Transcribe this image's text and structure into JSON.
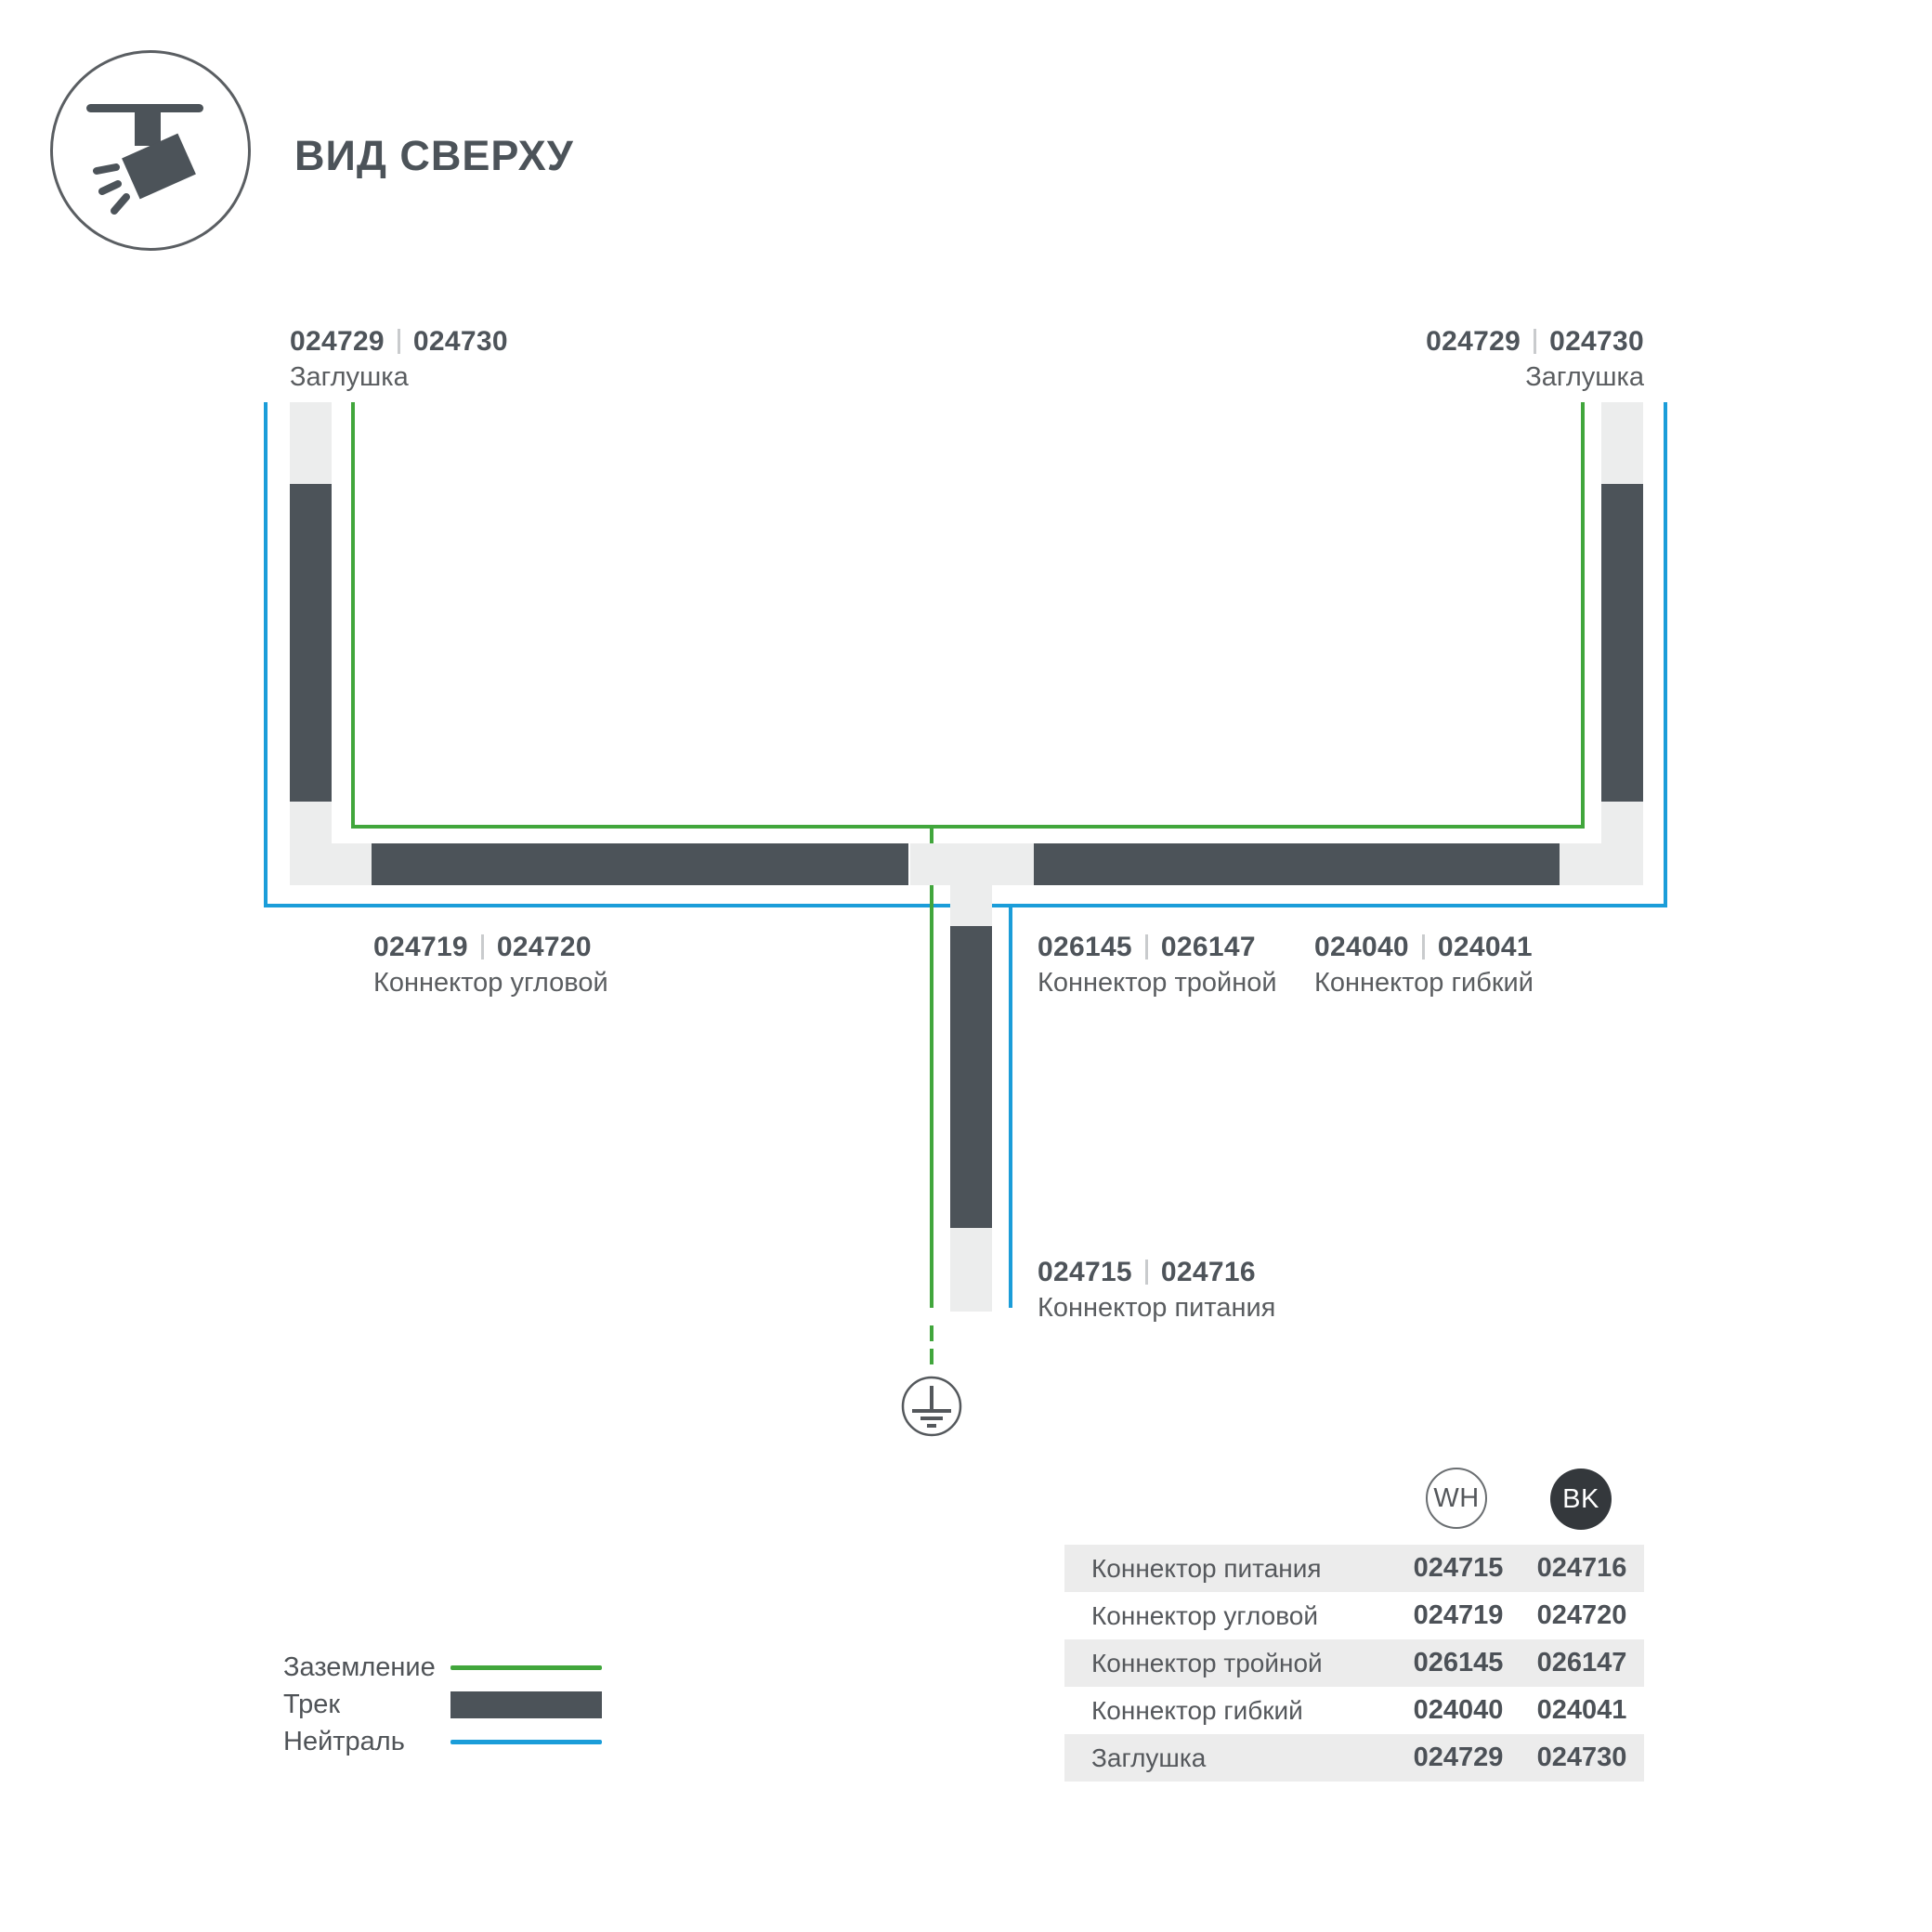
{
  "header": {
    "title": "ВИД СВЕРХУ"
  },
  "diagram": {
    "labels": {
      "endcap_left": {
        "code_wh": "024729",
        "code_bk": "024730",
        "name": "Заглушка"
      },
      "endcap_right": {
        "code_wh": "024729",
        "code_bk": "024730",
        "name": "Заглушка"
      },
      "corner": {
        "code_wh": "024719",
        "code_bk": "024720",
        "name": "Коннектор угловой"
      },
      "triple": {
        "code_wh": "026145",
        "code_bk": "026147",
        "name": "Коннектор тройной"
      },
      "flexible": {
        "code_wh": "024040",
        "code_bk": "024041",
        "name": "Коннектор гибкий"
      },
      "power": {
        "code_wh": "024715",
        "code_bk": "024716",
        "name": "Коннектор питания"
      }
    },
    "colors": {
      "ground_line": "#41A63C",
      "neutral_line": "#1B9DD9",
      "track": "#4C5359",
      "connector": "#ECEDED"
    }
  },
  "legend": {
    "items": [
      {
        "label": "Заземление",
        "swatch": "green-line"
      },
      {
        "label": "Трек",
        "swatch": "dark-bar"
      },
      {
        "label": "Нейтраль",
        "swatch": "blue-line"
      }
    ]
  },
  "table": {
    "columns": [
      {
        "code": "WH"
      },
      {
        "code": "BK"
      }
    ],
    "rows": [
      {
        "name": "Коннектор питания",
        "wh": "024715",
        "bk": "024716"
      },
      {
        "name": "Коннектор угловой",
        "wh": "024719",
        "bk": "024720"
      },
      {
        "name": "Коннектор тройной",
        "wh": "026145",
        "bk": "026147"
      },
      {
        "name": "Коннектор гибкий",
        "wh": "024040",
        "bk": "024041"
      },
      {
        "name": "Заглушка",
        "wh": "024729",
        "bk": "024730"
      }
    ]
  }
}
